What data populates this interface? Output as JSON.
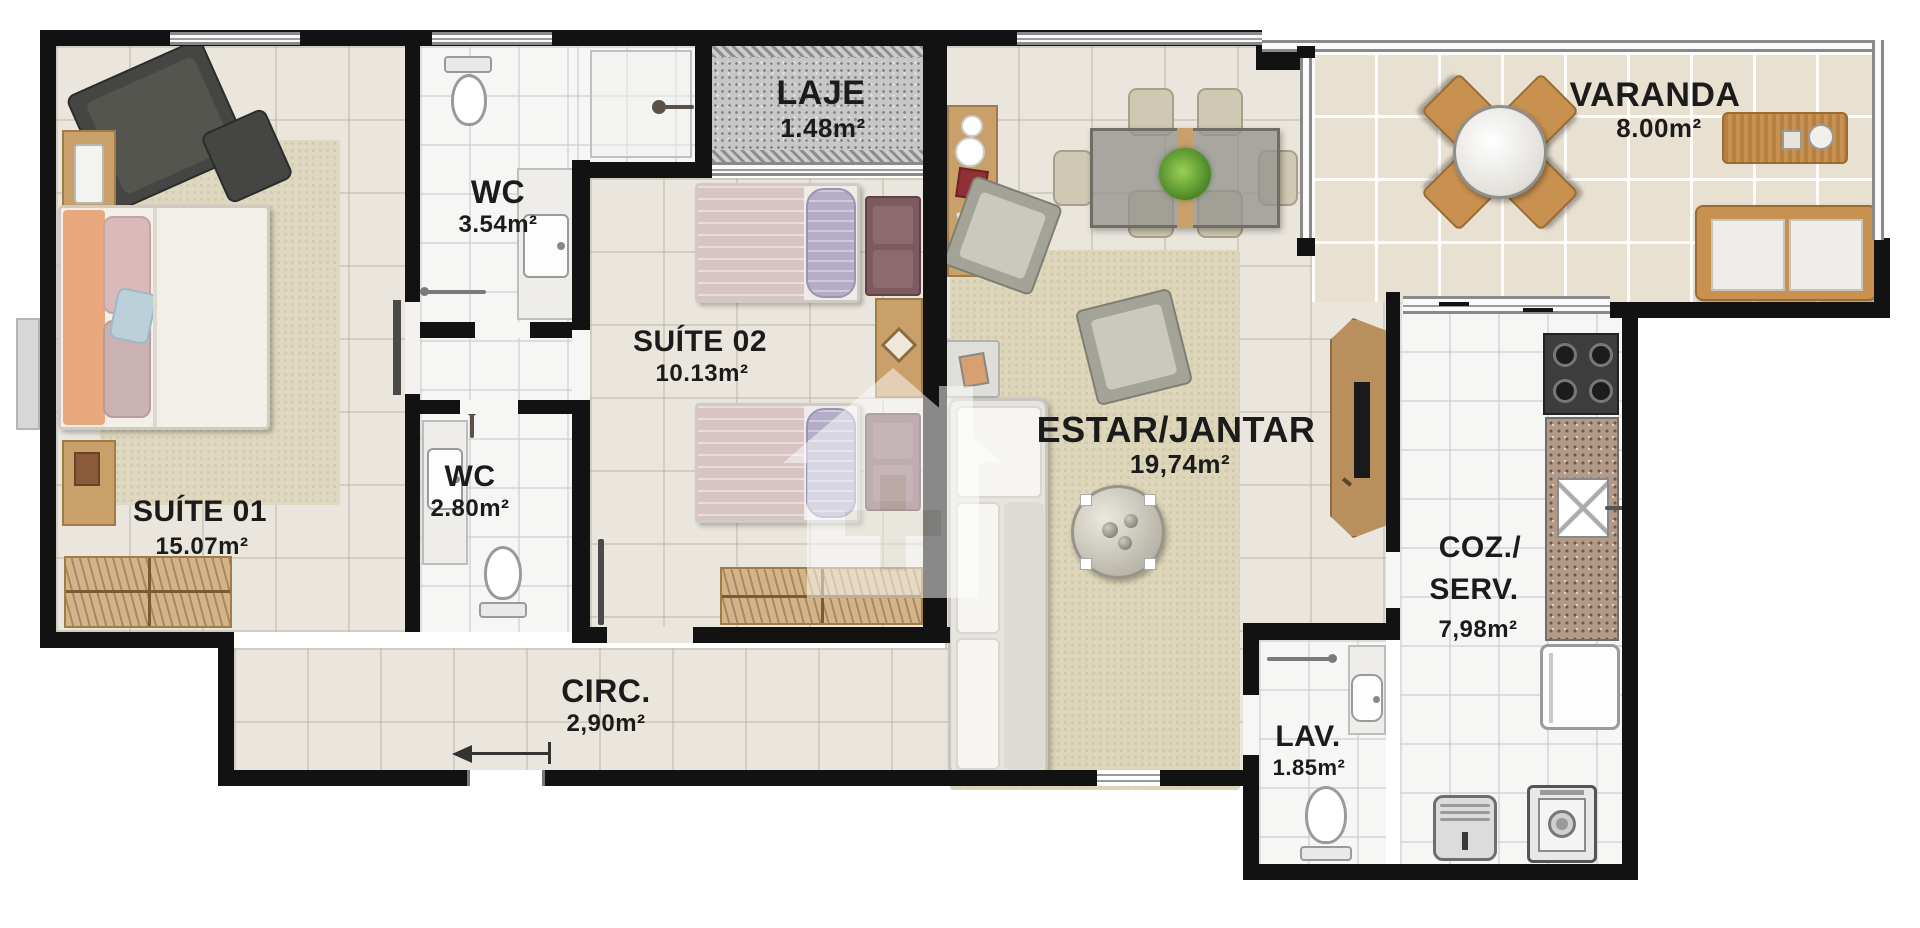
{
  "plan_title": "apartment-floor-plan",
  "rooms": {
    "suite01": {
      "name": "SUÍTE 01",
      "area": "15.07m²"
    },
    "wc1": {
      "name": "WC",
      "area": "3.54m²"
    },
    "wc2": {
      "name": "WC",
      "area": "2.80m²"
    },
    "suite02": {
      "name": "SUÍTE 02",
      "area": "10.13m²"
    },
    "laje": {
      "name": "LAJE",
      "area": "1.48m²"
    },
    "estar": {
      "name": "ESTAR/JANTAR",
      "area": "19,74m²"
    },
    "varanda": {
      "name": "VARANDA",
      "area": "8.00m²"
    },
    "coz": {
      "name_line1": "COZ./",
      "name_line2": "SERV.",
      "area": "7,98m²"
    },
    "lav": {
      "name": "LAV.",
      "area": "1.85m²"
    },
    "circ": {
      "name": "CIRC.",
      "area": "2,90m²"
    }
  },
  "colors": {
    "wall": "#121212",
    "floor_beige": "#eae6dd",
    "floor_white": "#f6f6f4",
    "floor_varanda": "#e8e1d1",
    "laje_gray": "#c7c7c7",
    "wood": "#c9a06a",
    "wicker": "#c8914f",
    "maroon_accent": "#7d5a60",
    "duvet_mauve": "#d9c4c4",
    "pillow_lilac": "#b3adc8",
    "pillow_orange": "#e9a87e"
  }
}
